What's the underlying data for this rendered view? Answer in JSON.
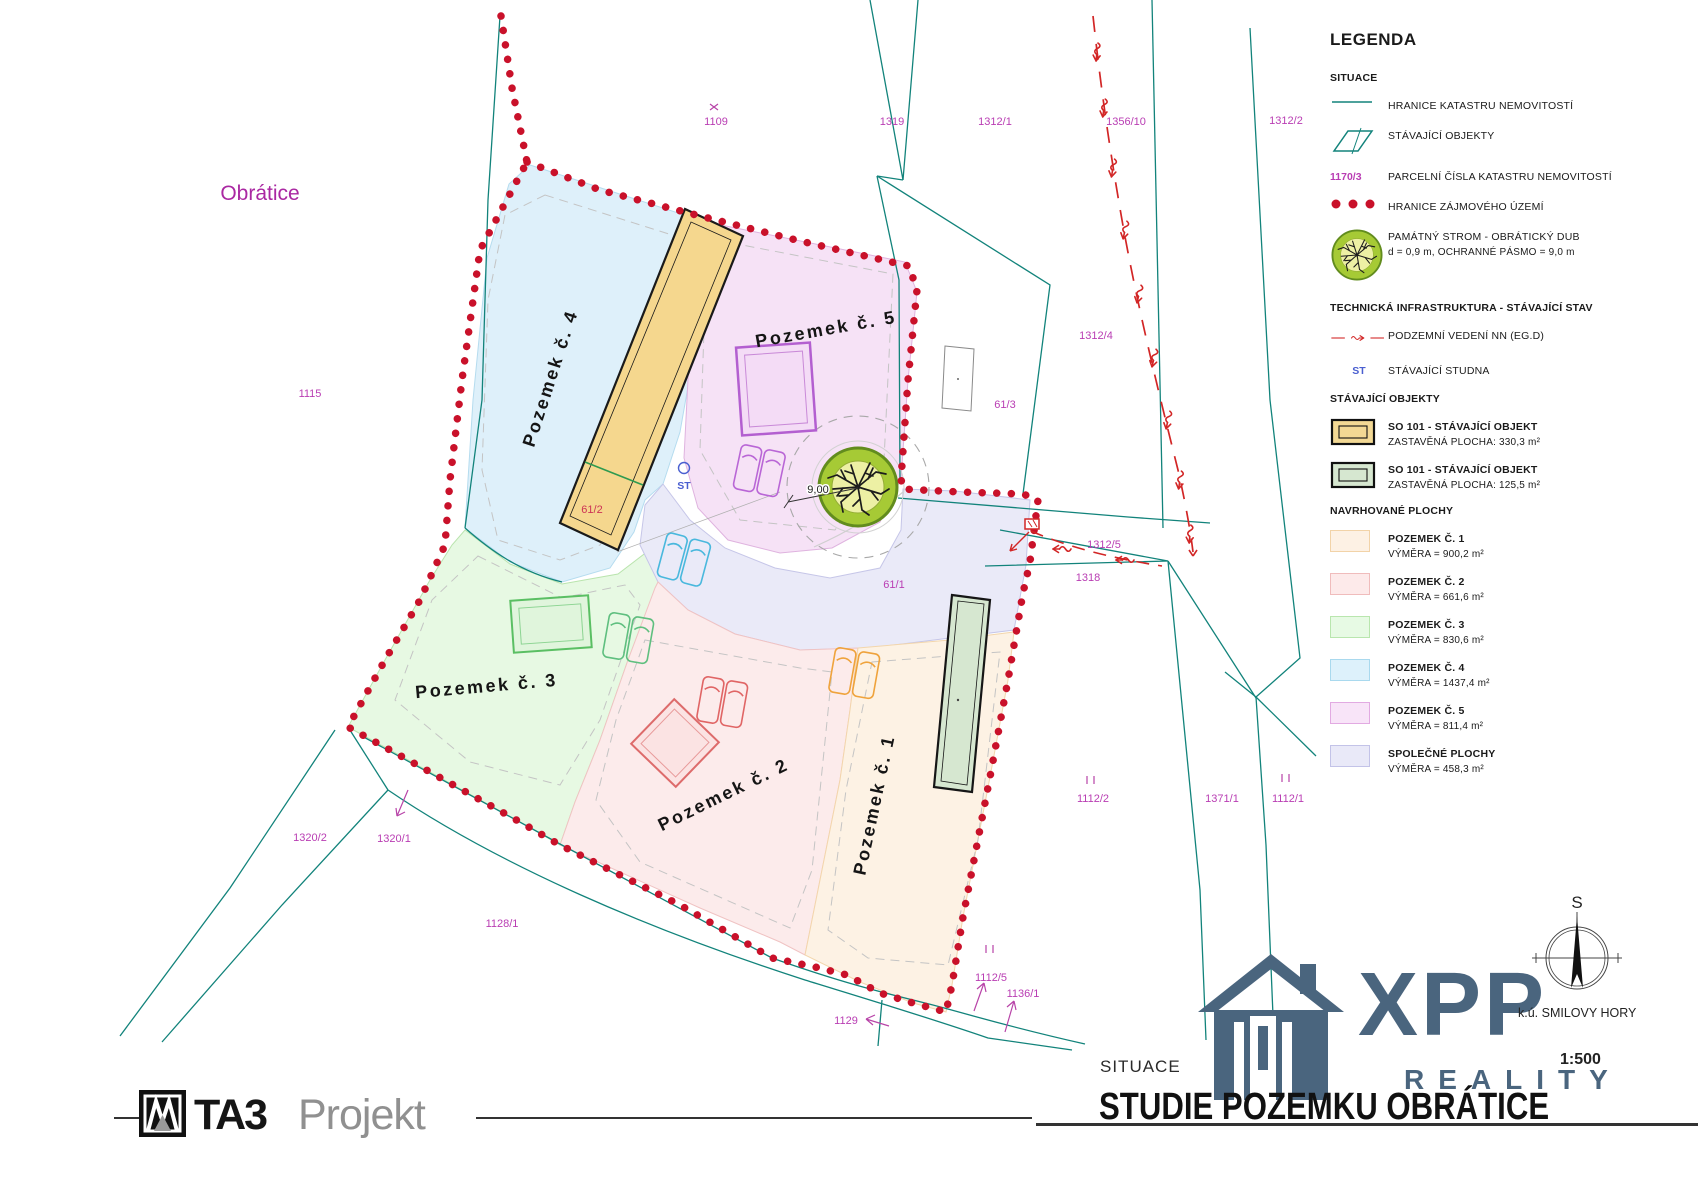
{
  "title_block": {
    "situace_label": "SITUACE",
    "main_title": "STUDIE POZEMKU OBRÁTICE",
    "scale": "1:500",
    "cadastral_area": "k.ú. SMILOVY HORY",
    "compass_north": "S"
  },
  "logos": {
    "ta3": {
      "name": "TA3",
      "suffix": "Projekt"
    },
    "xpp": {
      "name": "XPP",
      "tagline": "REALITY"
    }
  },
  "legend": {
    "title": "LEGENDA",
    "situace_header": "SITUACE",
    "items_situace": [
      {
        "label": "HRANICE KATASTRU NEMOVITOSTÍ"
      },
      {
        "label": "STÁVAJÍCÍ OBJEKTY"
      },
      {
        "symbol_text": "1170/3",
        "label": "PARCELNÍ ČÍSLA KATASTRU NEMOVITOSTÍ"
      },
      {
        "label": "HRANICE ZÁJMOVÉHO ÚZEMÍ"
      },
      {
        "label": "PAMÁTNÝ STROM - OBRÁTICKÝ DUB",
        "sub": "d = 0,9 m, OCHRANNÉ PÁSMO = 9,0 m"
      }
    ],
    "tech_header": "TECHNICKÁ INFRASTRUKTURA - STÁVAJÍCÍ STAV",
    "items_tech": [
      {
        "label": "PODZEMNÍ VEDENÍ NN (EG.D)"
      },
      {
        "symbol_text": "ST",
        "label": "STÁVAJÍCÍ STUDNA"
      }
    ],
    "objekty_header": "STÁVAJÍCÍ OBJEKTY",
    "items_objekty": [
      {
        "label": "SO 101 - STÁVAJÍCÍ OBJEKT",
        "sub": "ZASTAVĚNÁ PLOCHA: 330,3 m²"
      },
      {
        "label": "SO 101 - STÁVAJÍCÍ OBJEKT",
        "sub": "ZASTAVĚNÁ PLOCHA: 125,5 m²"
      }
    ],
    "plochy_header": "NAVRHOVANÉ PLOCHY",
    "items_plochy": [
      {
        "label": "POZEMEK Č. 1",
        "sub": "VÝMĚRA = 900,2 m²"
      },
      {
        "label": "POZEMEK Č. 2",
        "sub": "VÝMĚRA = 661,6 m²"
      },
      {
        "label": "POZEMEK Č. 3",
        "sub": "VÝMĚRA = 830,6 m²"
      },
      {
        "label": "POZEMEK Č. 4",
        "sub": "VÝMĚRA = 1437,4 m²"
      },
      {
        "label": "POZEMEK Č. 5",
        "sub": "VÝMĚRA = 811,4 m²"
      },
      {
        "label": "SPOLEČNÉ PLOCHY",
        "sub": "VÝMĚRA = 458,3 m²"
      }
    ]
  },
  "map": {
    "place_label": "Obrátice",
    "dimension_label": "9,00",
    "well_label": "ST",
    "parcel_labels": [
      {
        "text": "1115"
      },
      {
        "text": "1109"
      },
      {
        "text": "1319"
      },
      {
        "text": "1312/1"
      },
      {
        "text": "1356/10"
      },
      {
        "text": "1312/2"
      },
      {
        "text": "1312/4"
      },
      {
        "text": "61/3"
      },
      {
        "text": "61/2"
      },
      {
        "text": "61/1"
      },
      {
        "text": "1312/5"
      },
      {
        "text": "1318"
      },
      {
        "text": "1112/2"
      },
      {
        "text": "1371/1"
      },
      {
        "text": "1112/1"
      },
      {
        "text": "1320/2"
      },
      {
        "text": "1320/1"
      },
      {
        "text": "1128/1"
      },
      {
        "text": "1129"
      },
      {
        "text": "1112/5"
      },
      {
        "text": "1136/1"
      }
    ],
    "area_labels": [
      {
        "text": "Pozemek č. 4"
      },
      {
        "text": "Pozemek č. 5"
      },
      {
        "text": "Pozemek č. 3"
      },
      {
        "text": "Pozemek č. 2"
      },
      {
        "text": "Pozemek č. 1"
      }
    ]
  },
  "colors": {
    "cadastre_line": "#12837b",
    "interest_boundary": "#c9112a",
    "cable_red": "#d22626",
    "parcel_number_magenta": "#b93db3",
    "brand_slate": "#4a657e"
  }
}
